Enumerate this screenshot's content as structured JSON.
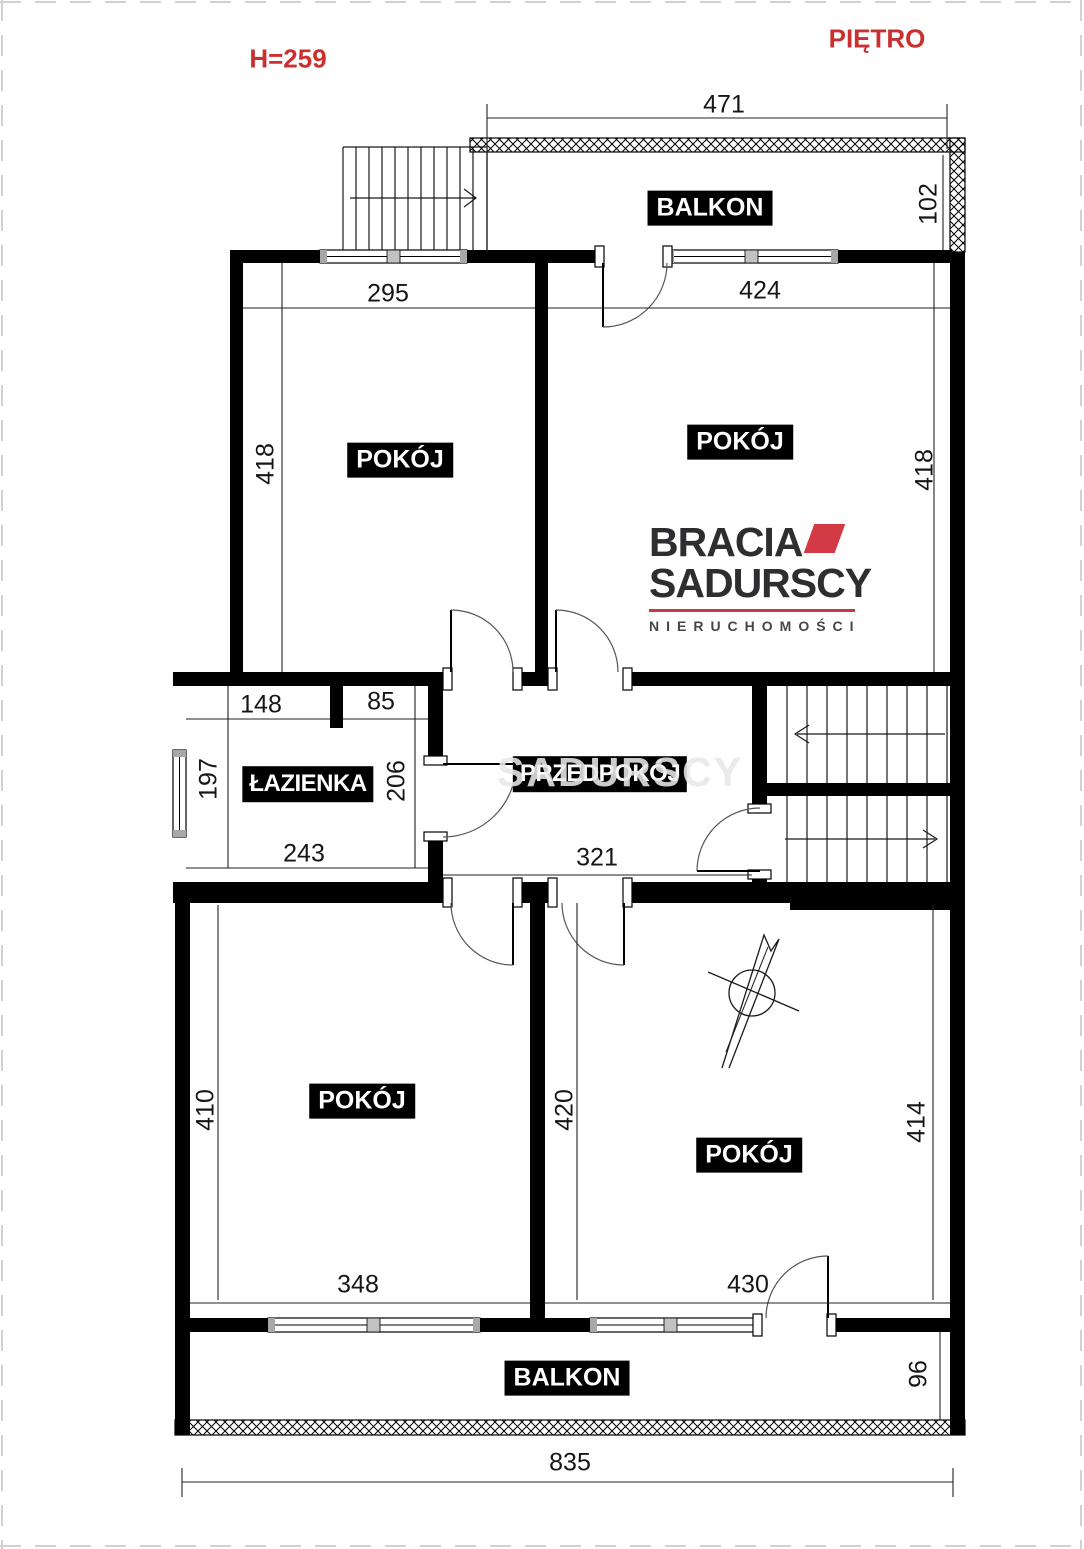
{
  "meta": {
    "floor_title": "PIĘTRO",
    "ceiling_height": "H=259"
  },
  "labels": {
    "balcony_top": "BALKON",
    "balcony_bottom": "BALKON",
    "room_top_left": "POKÓJ",
    "room_top_right": "POKÓJ",
    "bathroom": "ŁAZIENKA",
    "hallway": "PRZEDPOKÓJ",
    "room_bottom_left": "POKÓJ",
    "room_bottom_right": "POKÓJ"
  },
  "dimensions": {
    "balcony_top_width": "471",
    "balcony_top_depth": "102",
    "room_tl_width": "295",
    "room_tl_height": "418",
    "room_tr_width": "424",
    "room_tr_height": "418",
    "bath_width_left": "148",
    "bath_width_right": "85",
    "bath_height_left": "197",
    "bath_height_right": "206",
    "bath_width_bottom": "243",
    "hall_width": "321",
    "room_bl_height": "410",
    "room_bl_width": "348",
    "room_br_height_left": "420",
    "room_br_height_right": "414",
    "room_br_width": "430",
    "balcony_bottom_depth": "96",
    "total_width": "835"
  },
  "logo": {
    "line1": "BRACIA",
    "line2": "SADURSCY",
    "tagline": "NIERUCHOMOŚCI"
  },
  "watermark": "SADURSCY",
  "colors": {
    "accent_red": "#c9302f",
    "logo_red": "#d23b45",
    "logo_text": "#2e2e30",
    "wall_black": "#000000"
  }
}
